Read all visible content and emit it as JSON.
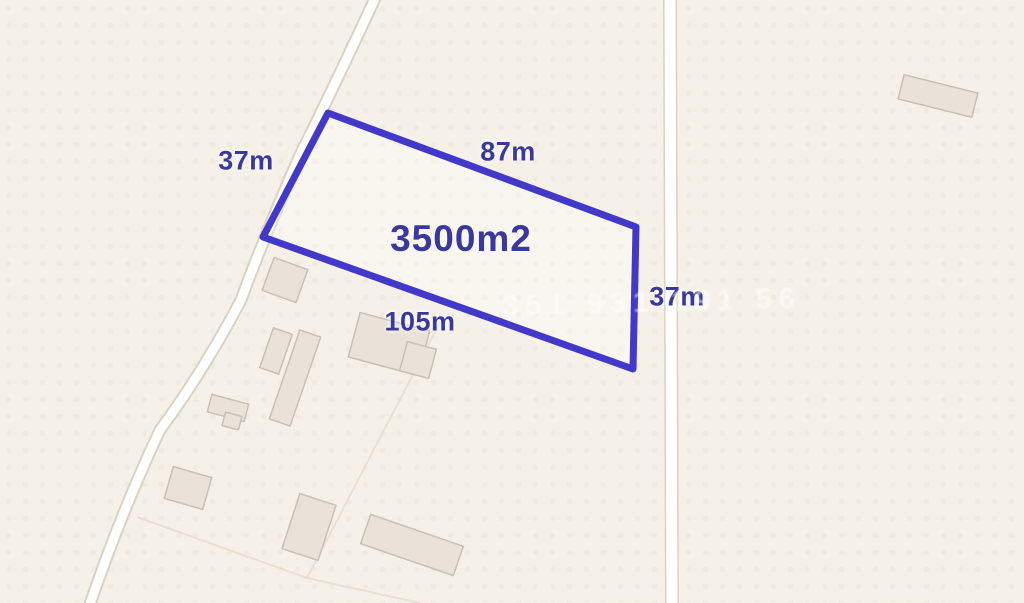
{
  "map": {
    "colors": {
      "background": "#f6f1e8",
      "dot_texture": "#ece5d6",
      "road_fill": "#ffffff",
      "road_border": "#d9d2c4",
      "building_fill": "#e8e2d9",
      "building_border": "#c8c0b3",
      "parcel_line": "#e8e1d3",
      "plot_outline": "#4239cb",
      "plot_fill": "rgba(255,255,255,0.30)",
      "label_ink": "#39389f"
    },
    "plot": {
      "area_label": "3500m2",
      "area_label_pos": {
        "x": 461,
        "y": 239
      },
      "side_labels": [
        {
          "text": "37m",
          "x": 246,
          "y": 161
        },
        {
          "text": "87m",
          "x": 508,
          "y": 152
        },
        {
          "text": "37m",
          "x": 677,
          "y": 297
        },
        {
          "text": "105m",
          "x": 420,
          "y": 322
        }
      ],
      "vertices": "328,113 636,227 633,369 263,237"
    },
    "watermark": {
      "text": "351 931 191 56",
      "x": 652,
      "y": 303
    },
    "roads": [
      {
        "name": "road-diagonal",
        "path": "M 377 -6 Q 335 85 300 155 Q 262 242 241 300 Q 203 372 160 430 Q 120 515 88 610",
        "outer": 13,
        "inner": 9
      },
      {
        "name": "road-vertical",
        "path": "M 670 -6 L 672 610",
        "outer": 14,
        "inner": 11
      }
    ],
    "parcel_lines": [
      "M 444 315 L 307 578 L 420 603",
      "M 137 517 L 307 578"
    ],
    "buildings": [
      {
        "cx": 938,
        "cy": 96,
        "w": 76,
        "h": 25,
        "rot": 14
      },
      {
        "cx": 285,
        "cy": 280,
        "w": 36,
        "h": 35,
        "rot": 20
      },
      {
        "cx": 389,
        "cy": 344,
        "w": 72,
        "h": 46,
        "rot": 15
      },
      {
        "cx": 418,
        "cy": 360,
        "w": 30,
        "h": 30,
        "rot": 15
      },
      {
        "cx": 276,
        "cy": 351,
        "w": 20,
        "h": 42,
        "rot": 19
      },
      {
        "cx": 295,
        "cy": 378,
        "w": 22,
        "h": 94,
        "rot": 19
      },
      {
        "cx": 228,
        "cy": 408,
        "w": 38,
        "h": 18,
        "rot": 15
      },
      {
        "cx": 232,
        "cy": 421,
        "w": 17,
        "h": 14,
        "rot": 15
      },
      {
        "cx": 188,
        "cy": 488,
        "w": 40,
        "h": 33,
        "rot": 16
      },
      {
        "cx": 309,
        "cy": 527,
        "w": 38,
        "h": 58,
        "rot": 18
      },
      {
        "cx": 412,
        "cy": 545,
        "w": 98,
        "h": 31,
        "rot": 19
      }
    ]
  }
}
